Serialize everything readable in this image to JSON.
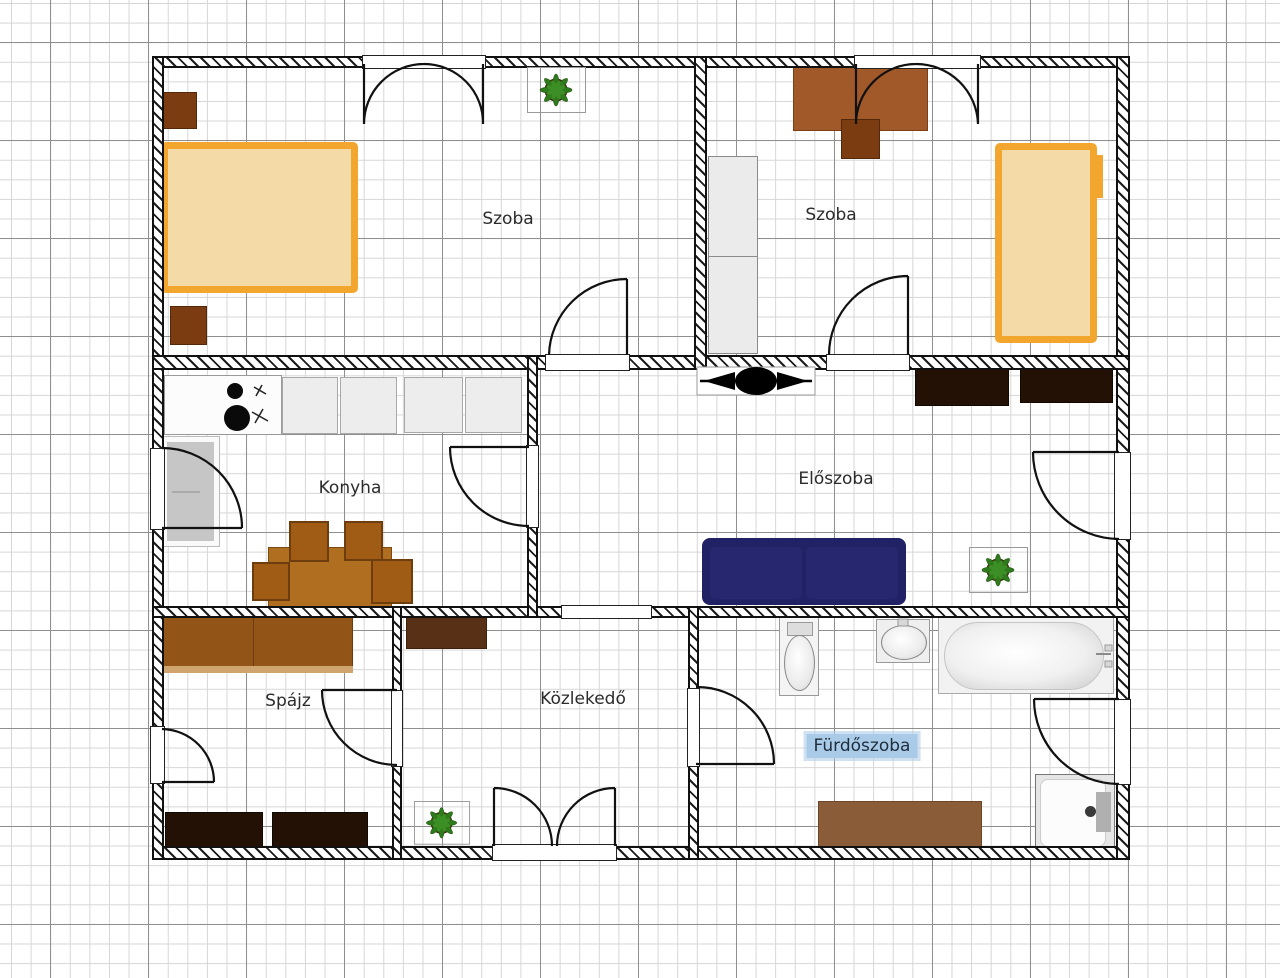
{
  "app": {
    "type": "floor-plan-editor",
    "background": "grid-paper"
  },
  "rooms": [
    {
      "id": "szoba-left",
      "label": "Szoba"
    },
    {
      "id": "szoba-right",
      "label": "Szoba"
    },
    {
      "id": "konyha",
      "label": "Konyha"
    },
    {
      "id": "eloszoba",
      "label": "Előszoba"
    },
    {
      "id": "spajz",
      "label": "Spájz"
    },
    {
      "id": "kozlekedo",
      "label": "Közlekedő"
    },
    {
      "id": "furdoszoba",
      "label": "Fürdőszoba",
      "selected": true
    }
  ],
  "furniture_icons": [
    "double-bed",
    "single-bed",
    "nightstand",
    "wardrobe",
    "desk",
    "desk-chair",
    "kitchen-counter",
    "stove",
    "refrigerator",
    "dining-table",
    "dining-chair",
    "sofa",
    "potted-plant",
    "ceiling-fan",
    "toilet",
    "sink",
    "bathtub",
    "shower",
    "dark-cabinet",
    "shelf",
    "rug",
    "double-entry-door",
    "casement-window",
    "interior-door"
  ],
  "colors": {
    "wall": "#111111",
    "grid_minor": "#d6d6d6",
    "grid_major": "#8f8f8f",
    "bed_frame": "#f2a62e",
    "bed_fill": "#f3daa7",
    "wood_dark": "#7a3c10",
    "wood_mid": "#a2592a",
    "table": "#b06e20",
    "sofa": "#212165",
    "dark_cabinet": "#241106",
    "plant_green": "#2f7a1c",
    "plant_pot": "#6b3a17",
    "label_text": "#2b2b2b",
    "label_highlight": "#a9cbe8"
  }
}
